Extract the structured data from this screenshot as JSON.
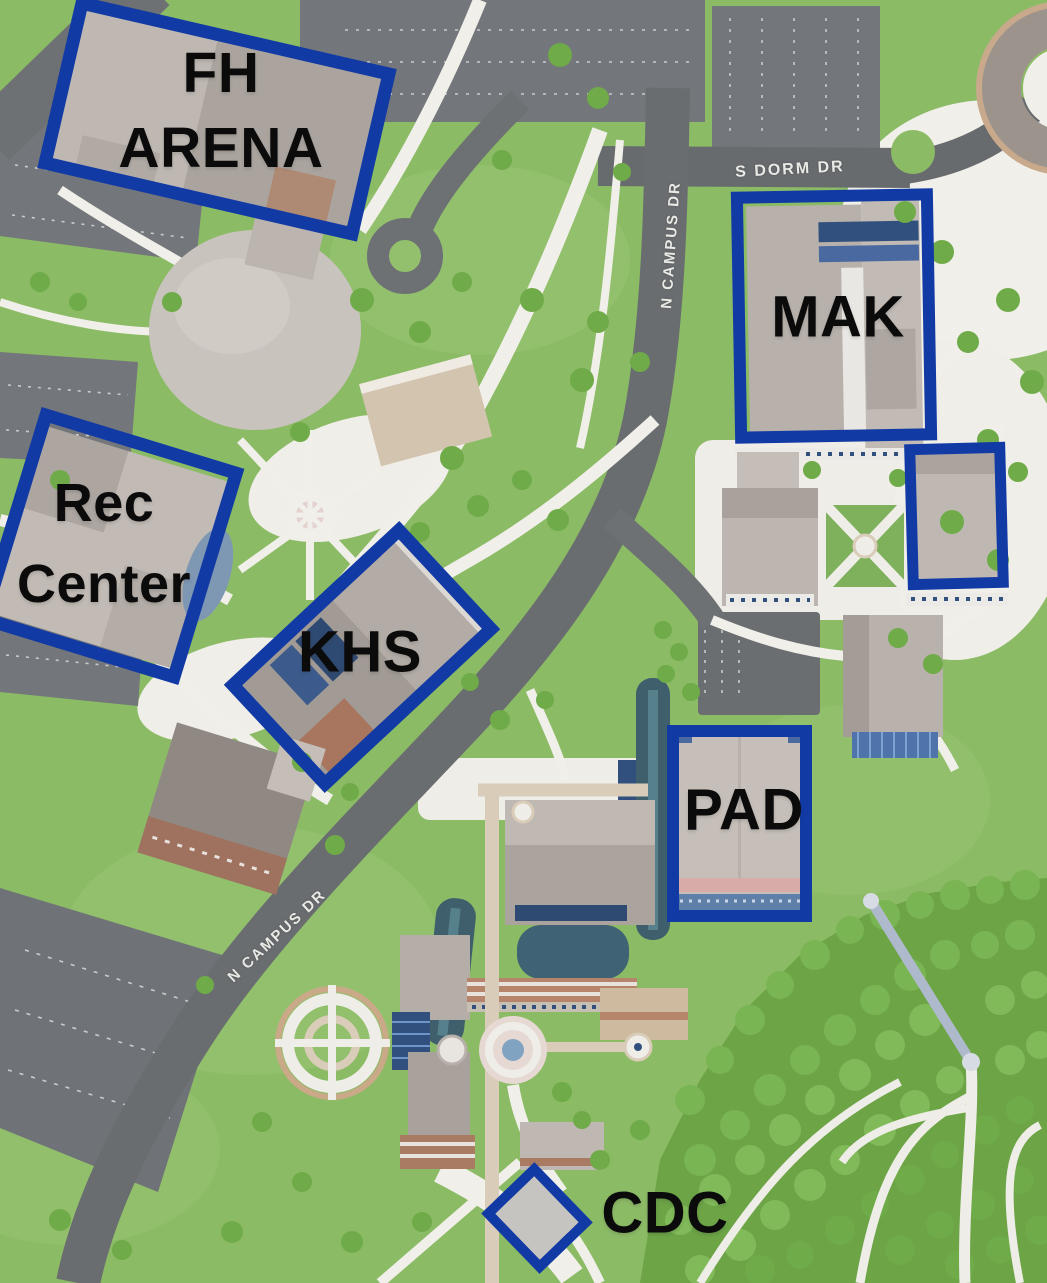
{
  "map": {
    "annotations": {
      "fh_arena": {
        "line1": "FH",
        "line2": "ARENA"
      },
      "rec_center": {
        "line1": "Rec",
        "line2": "Center"
      },
      "mak": {
        "label": "MAK"
      },
      "khs": {
        "label": "KHS"
      },
      "pad": {
        "label": "PAD"
      },
      "cdc": {
        "label": "CDC"
      }
    },
    "streets": {
      "s_dorm_dr": "S DORM DR",
      "n_campus_dr_upper": "N CAMPUS DR",
      "n_campus_dr_lower": "N CAMPUS DR"
    },
    "colors": {
      "highlight_blue": "#113AA5",
      "label_text": "#0B0B0B",
      "street_text": "#E9EAE6"
    }
  }
}
